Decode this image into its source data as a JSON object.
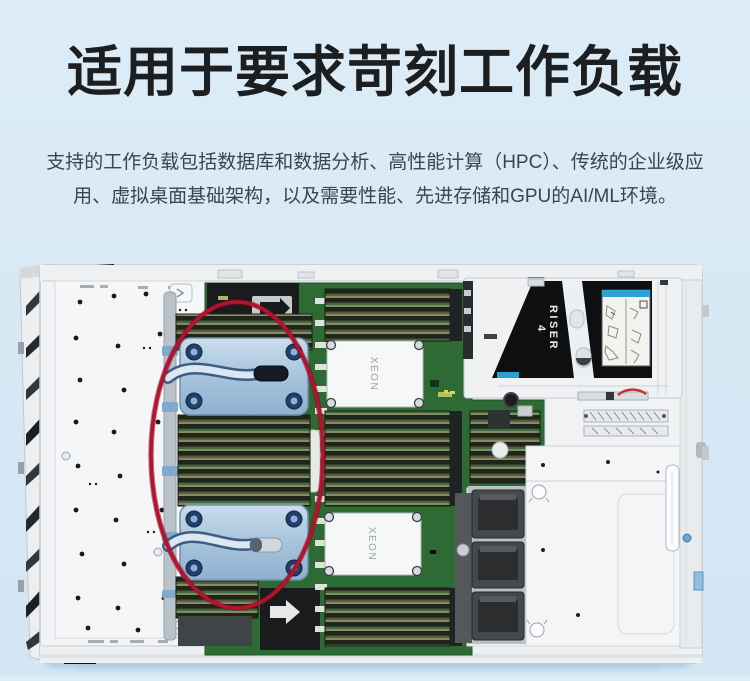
{
  "page": {
    "background_color": "#d8e9f6",
    "title": "适用于要求苛刻工作负载",
    "subtitle_line1": "支持的工作负载包括数据库和数据分析、高性能计算（HPC）、传统的企业级应",
    "subtitle_line2": "用、虚拟桌面基础架构，以及需要性能、先进存储和GPU的AI/ML环境。"
  },
  "server_image": {
    "labels": {
      "riser_label": "RISER",
      "riser_number": "4",
      "cpu_label": "XEON"
    },
    "colors": {
      "highlight_ellipse_red": "#b5122e",
      "pcb_green": "#2e6a34",
      "coolant_plate_blue": "#a9c6e0",
      "chassis_white": "#f1f3f5",
      "riser_black": "#0e0f10",
      "label_header_blue": "#2fa3d5"
    }
  }
}
